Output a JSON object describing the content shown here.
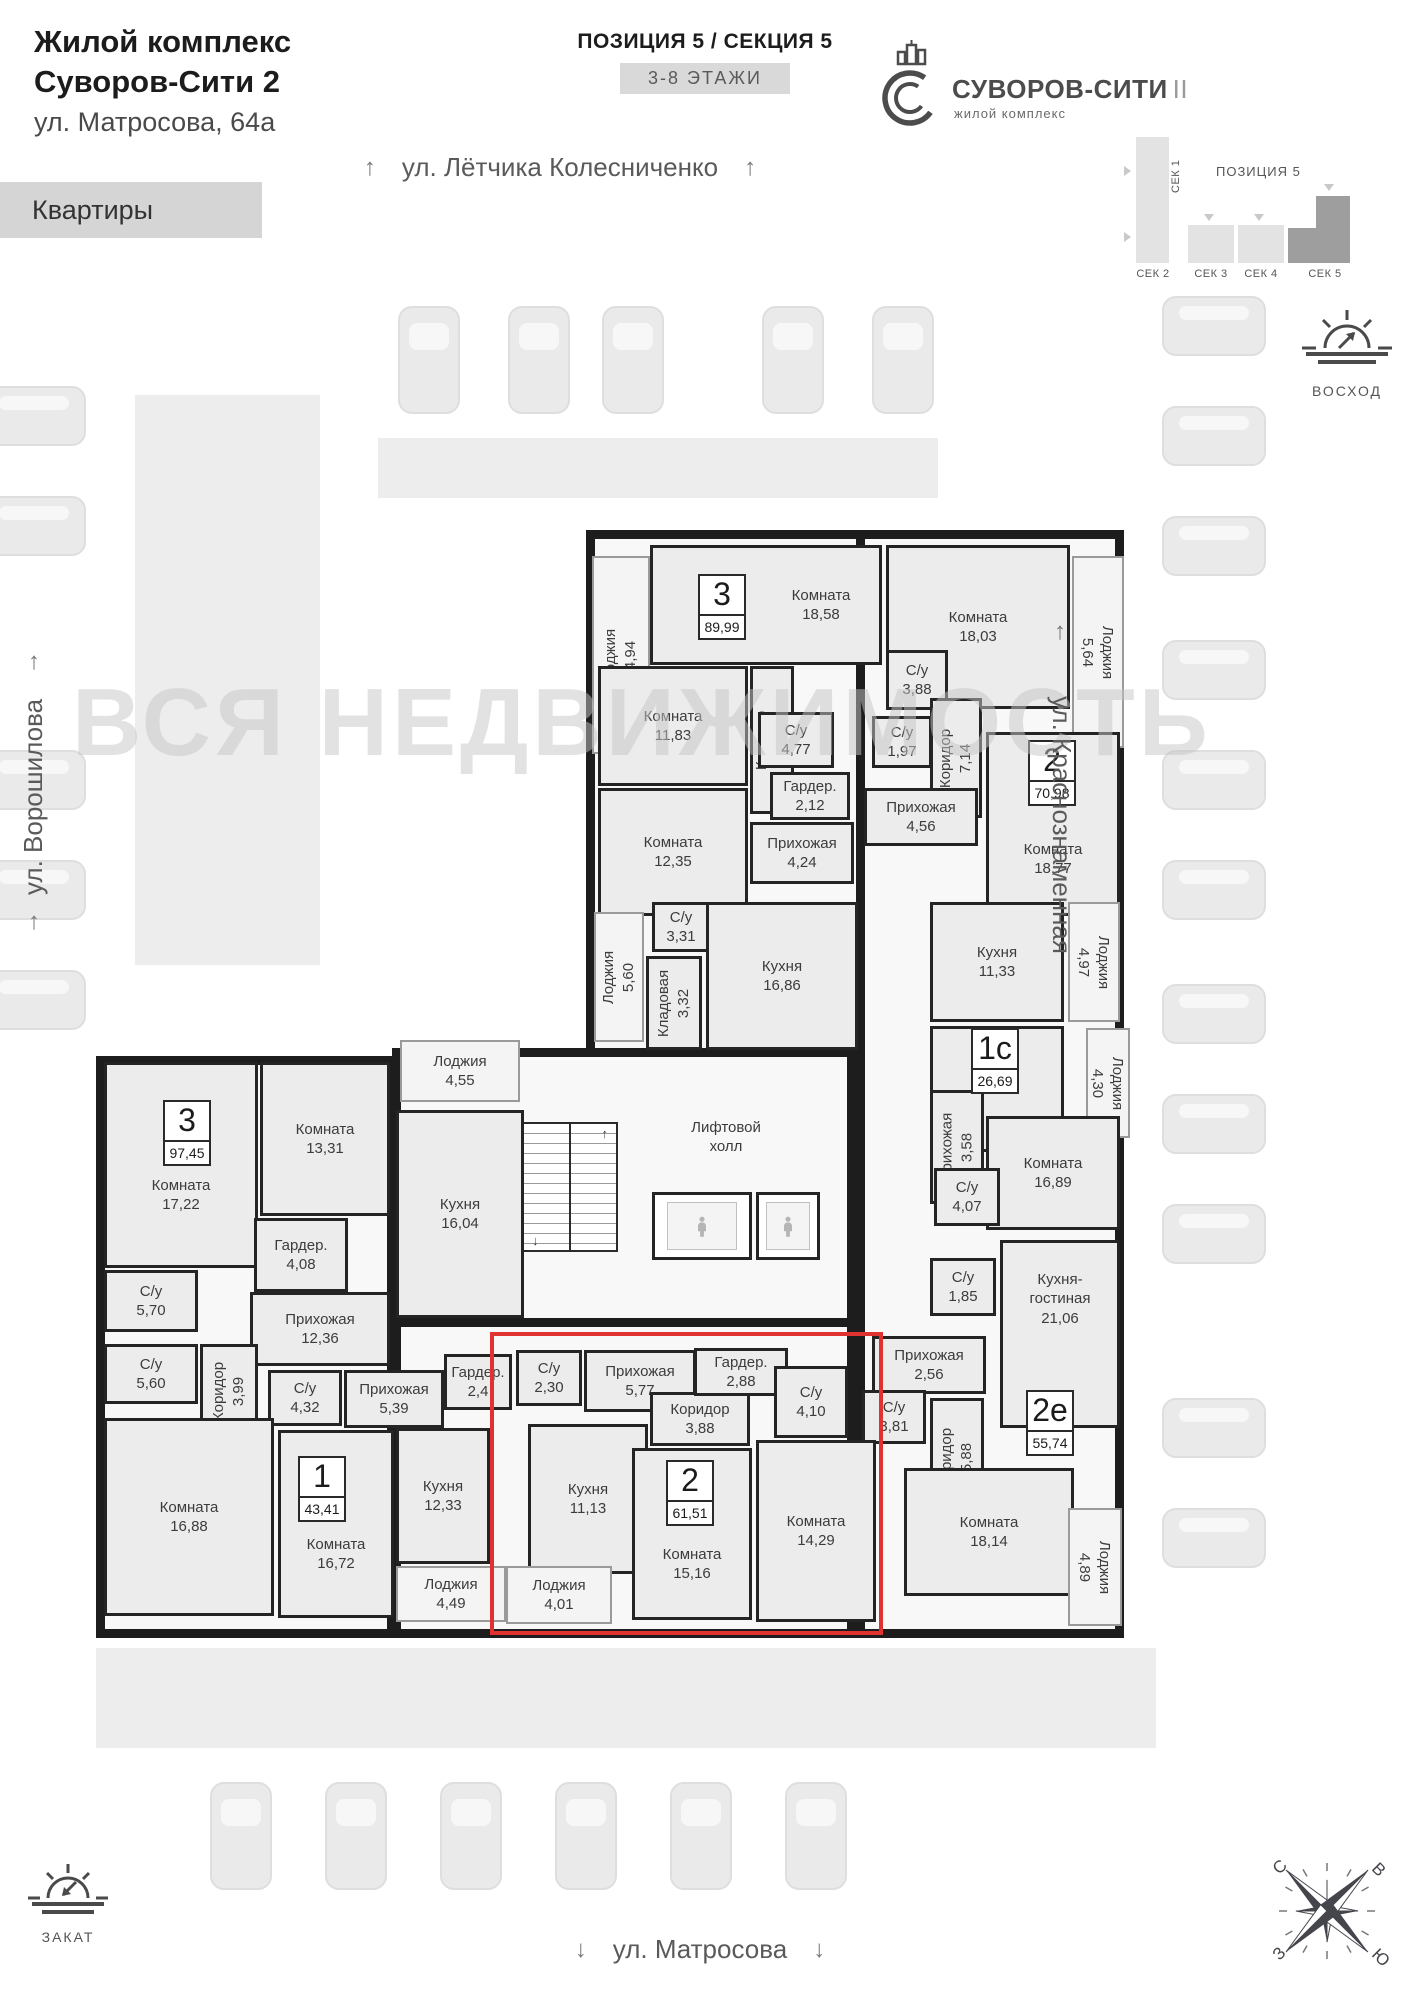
{
  "header": {
    "line1": "Жилой комплекс",
    "line2": "Суворов-Сити 2",
    "address": "ул. Матросова, 64а",
    "apartments_button": "Квартиры"
  },
  "position_header": {
    "title": "ПОЗИЦИЯ 5 / СЕКЦИЯ 5",
    "floors_badge": "3-8 ЭТАЖИ"
  },
  "logo": {
    "name": "СУВОРОВ-СИТИ",
    "suffix": "II",
    "subtitle": "жилой комплекс"
  },
  "minimap": {
    "position_label": "ПОЗИЦИЯ 5",
    "sections": [
      "СЕК 1",
      "СЕК 2",
      "СЕК 3",
      "СЕК 4",
      "СЕК 5"
    ]
  },
  "sun": {
    "sunrise": "ВОСХОД",
    "sunset": "ЗАКАТ"
  },
  "compass": {
    "north": "С",
    "east": "В",
    "west": "З",
    "south": "Ю"
  },
  "streets": {
    "top": "ул. Лётчика Колесниченко",
    "left": "ул. Ворошилова",
    "right": "ул. Краснознаменная",
    "bottom": "ул. Матросова",
    "arrow_up": "↑",
    "arrow_down": "↓"
  },
  "watermark": "ВСЯ НЕДВИЖИМОСТЬ",
  "plan": {
    "highlight": {
      "x": 490,
      "y": 1332,
      "w": 393,
      "h": 303,
      "color": "#e03331"
    },
    "wings": [
      [
        586,
        530,
        300,
        530
      ],
      [
        856,
        530,
        268,
        1108
      ],
      [
        96,
        1056,
        300,
        582
      ],
      [
        392,
        1048,
        464,
        282
      ],
      [
        392,
        1318,
        464,
        320
      ]
    ],
    "strips": [
      [
        378,
        438,
        560,
        60
      ],
      [
        135,
        395,
        185,
        570
      ],
      [
        96,
        1648,
        1060,
        100
      ]
    ],
    "cars": [
      [
        398,
        306,
        62,
        108
      ],
      [
        508,
        306,
        62,
        108
      ],
      [
        602,
        306,
        62,
        108
      ],
      [
        762,
        306,
        62,
        108
      ],
      [
        872,
        306,
        62,
        108
      ],
      [
        -18,
        386,
        104,
        60
      ],
      [
        -18,
        496,
        104,
        60
      ],
      [
        -18,
        750,
        104,
        60
      ],
      [
        -18,
        860,
        104,
        60
      ],
      [
        -18,
        970,
        104,
        60
      ],
      [
        1162,
        296,
        104,
        60
      ],
      [
        1162,
        406,
        104,
        60
      ],
      [
        1162,
        516,
        104,
        60
      ],
      [
        1162,
        640,
        104,
        60
      ],
      [
        1162,
        750,
        104,
        60
      ],
      [
        1162,
        860,
        104,
        60
      ],
      [
        1162,
        984,
        104,
        60
      ],
      [
        1162,
        1094,
        104,
        60
      ],
      [
        1162,
        1204,
        104,
        60
      ],
      [
        1162,
        1398,
        104,
        60
      ],
      [
        1162,
        1508,
        104,
        60
      ],
      [
        210,
        1782,
        62,
        108
      ],
      [
        325,
        1782,
        62,
        108
      ],
      [
        440,
        1782,
        62,
        108
      ],
      [
        555,
        1782,
        62,
        108
      ],
      [
        670,
        1782,
        62,
        108
      ],
      [
        785,
        1782,
        62,
        108
      ]
    ],
    "stairs": [
      522,
      1122,
      96,
      130
    ],
    "elevators": [
      [
        652,
        1192,
        100,
        68
      ],
      [
        756,
        1192,
        64,
        68
      ]
    ],
    "badges": [
      {
        "num": "3",
        "area": "89,99",
        "x": 698,
        "y": 574
      },
      {
        "num": "2",
        "area": "70,98",
        "x": 1028,
        "y": 740
      },
      {
        "num": "1с",
        "area": "26,69",
        "x": 971,
        "y": 1028
      },
      {
        "num": "2е",
        "area": "55,74",
        "x": 1026,
        "y": 1390
      },
      {
        "num": "3",
        "area": "97,45",
        "x": 163,
        "y": 1100
      },
      {
        "num": "1",
        "area": "43,41",
        "x": 298,
        "y": 1456
      },
      {
        "num": "2",
        "area": "61,51",
        "x": 666,
        "y": 1460
      }
    ],
    "rooms": [
      {
        "lines": [
          "Лоджия",
          "4,94"
        ],
        "r": [
          592,
          556,
          58,
          198
        ],
        "k": "loggia",
        "rot": 1
      },
      {
        "lines": [
          "Комната",
          "18,58"
        ],
        "r": [
          650,
          545,
          232,
          120
        ],
        "pl": 110
      },
      {
        "lines": [
          "Комната",
          "11,83"
        ],
        "r": [
          598,
          666,
          150,
          120
        ]
      },
      {
        "lines": [
          "Комната",
          "12,35"
        ],
        "r": [
          598,
          788,
          150,
          128
        ]
      },
      {
        "lines": [
          "Коридор",
          "7,34"
        ],
        "r": [
          750,
          666,
          44,
          148
        ],
        "rot": 1
      },
      {
        "lines": [
          "С/у",
          "4,77"
        ],
        "r": [
          758,
          712,
          76,
          56
        ]
      },
      {
        "lines": [
          "Гардер.",
          "2,12"
        ],
        "r": [
          770,
          772,
          80,
          48
        ]
      },
      {
        "lines": [
          "Прихожая",
          "4,24"
        ],
        "r": [
          750,
          822,
          104,
          62
        ]
      },
      {
        "lines": [
          "С/у",
          "3,31"
        ],
        "r": [
          652,
          902,
          58,
          50
        ]
      },
      {
        "lines": [
          "Кладовая",
          "3,32"
        ],
        "r": [
          646,
          956,
          56,
          94
        ],
        "rot": 1
      },
      {
        "lines": [
          "Кухня",
          "16,86"
        ],
        "r": [
          706,
          902,
          152,
          148
        ]
      },
      {
        "lines": [
          "Лоджия",
          "5,60"
        ],
        "r": [
          594,
          912,
          50,
          130
        ],
        "k": "loggia",
        "rot": 1
      },
      {
        "lines": [
          "Комната",
          "18,03"
        ],
        "r": [
          886,
          545,
          184,
          164
        ]
      },
      {
        "lines": [
          "Лоджия",
          "5,64"
        ],
        "r": [
          1072,
          556,
          52,
          192
        ],
        "k": "loggia",
        "rot": 2
      },
      {
        "lines": [
          "С/у",
          "3,88"
        ],
        "r": [
          886,
          650,
          62,
          60
        ]
      },
      {
        "lines": [
          "С/у",
          "1,97"
        ],
        "r": [
          872,
          716,
          60,
          52
        ]
      },
      {
        "lines": [
          "Коридор",
          "7,14"
        ],
        "r": [
          930,
          698,
          52,
          120
        ],
        "rot": 1
      },
      {
        "lines": [
          "Прихожая",
          "4,56"
        ],
        "r": [
          864,
          788,
          114,
          58
        ]
      },
      {
        "lines": [
          "Комната",
          "18,77"
        ],
        "r": [
          986,
          732,
          134,
          184
        ],
        "pt": 70
      },
      {
        "lines": [
          "Кухня",
          "11,33"
        ],
        "r": [
          930,
          902,
          134,
          120
        ]
      },
      {
        "lines": [
          "Лоджия",
          "4,97"
        ],
        "r": [
          1068,
          902,
          52,
          120
        ],
        "k": "loggia",
        "rot": 2
      },
      {
        "lines": [],
        "r": [
          930,
          1026,
          134,
          126
        ]
      },
      {
        "lines": [
          "Лоджия",
          "4,30"
        ],
        "r": [
          1086,
          1028,
          44,
          110
        ],
        "k": "loggia",
        "rot": 2
      },
      {
        "lines": [
          "Прихожая",
          "3,58"
        ],
        "r": [
          930,
          1090,
          54,
          114
        ],
        "rot": 1
      },
      {
        "lines": [
          "Комната",
          "16,89"
        ],
        "r": [
          986,
          1116,
          134,
          114
        ]
      },
      {
        "lines": [
          "С/у",
          "4,07"
        ],
        "r": [
          934,
          1168,
          66,
          58
        ]
      },
      {
        "lines": [
          "С/у",
          "1,85"
        ],
        "r": [
          930,
          1258,
          66,
          58
        ]
      },
      {
        "lines": [
          "Кухня-",
          "гостиная",
          "21,06"
        ],
        "r": [
          1000,
          1240,
          120,
          188
        ],
        "pb": 70
      },
      {
        "lines": [
          "Прихожая",
          "2,56"
        ],
        "r": [
          872,
          1336,
          114,
          58
        ]
      },
      {
        "lines": [
          "С/у",
          "3,81"
        ],
        "r": [
          862,
          1390,
          64,
          54
        ]
      },
      {
        "lines": [
          "Коридор",
          "5,88"
        ],
        "r": [
          930,
          1398,
          54,
          118
        ],
        "rot": 1
      },
      {
        "lines": [
          "Комната",
          "18,14"
        ],
        "r": [
          904,
          1468,
          170,
          128
        ]
      },
      {
        "lines": [
          "Лоджия",
          "4,89"
        ],
        "r": [
          1068,
          1508,
          54,
          118
        ],
        "k": "loggia",
        "rot": 2
      },
      {
        "lines": [
          "Лоджия",
          "4,55"
        ],
        "r": [
          400,
          1040,
          120,
          62
        ],
        "k": "loggia"
      },
      {
        "lines": [
          "Кухня",
          "16,04"
        ],
        "r": [
          396,
          1110,
          128,
          208
        ]
      },
      {
        "lines": [
          "Лифтовой",
          "холл"
        ],
        "r": [
          636,
          1072,
          180,
          130
        ],
        "k": "open"
      },
      {
        "lines": [
          "Комната",
          "17,22"
        ],
        "r": [
          104,
          1062,
          154,
          206
        ],
        "pt": 60
      },
      {
        "lines": [
          "Комната",
          "13,31"
        ],
        "r": [
          260,
          1062,
          130,
          154
        ]
      },
      {
        "lines": [
          "Гардер.",
          "4,08"
        ],
        "r": [
          254,
          1218,
          94,
          74
        ]
      },
      {
        "lines": [
          "С/у",
          "5,70"
        ],
        "r": [
          104,
          1270,
          94,
          62
        ]
      },
      {
        "lines": [
          "Прихожая",
          "12,36"
        ],
        "r": [
          250,
          1292,
          140,
          74
        ]
      },
      {
        "lines": [
          "С/у",
          "5,60"
        ],
        "r": [
          104,
          1344,
          94,
          60
        ]
      },
      {
        "lines": [
          "Коридор",
          "3,99"
        ],
        "r": [
          200,
          1344,
          58,
          94
        ],
        "rot": 1
      },
      {
        "lines": [
          "С/у",
          "4,32"
        ],
        "r": [
          268,
          1370,
          74,
          56
        ]
      },
      {
        "lines": [
          "Комната",
          "16,88"
        ],
        "r": [
          104,
          1418,
          170,
          198
        ]
      },
      {
        "lines": [
          "Прихожая",
          "5,39"
        ],
        "r": [
          344,
          1370,
          100,
          58
        ]
      },
      {
        "lines": [
          "Комната",
          "16,72"
        ],
        "r": [
          278,
          1430,
          116,
          188
        ],
        "pt": 60
      },
      {
        "lines": [
          "Кухня",
          "12,33"
        ],
        "r": [
          396,
          1428,
          94,
          136
        ]
      },
      {
        "lines": [
          "Лоджия",
          "4,49"
        ],
        "r": [
          396,
          1566,
          110,
          56
        ],
        "k": "loggia"
      },
      {
        "lines": [
          "Гардер.",
          "2,4"
        ],
        "r": [
          444,
          1354,
          68,
          56
        ]
      },
      {
        "lines": [
          "С/у",
          "2,30"
        ],
        "r": [
          516,
          1350,
          66,
          56
        ]
      },
      {
        "lines": [
          "Прихожая",
          "5,77"
        ],
        "r": [
          584,
          1350,
          112,
          62
        ]
      },
      {
        "lines": [
          "Кухня",
          "11,13"
        ],
        "r": [
          528,
          1424,
          120,
          150
        ]
      },
      {
        "lines": [
          "Коридор",
          "3,88"
        ],
        "r": [
          650,
          1392,
          100,
          54
        ]
      },
      {
        "lines": [
          "Комната",
          "15,16"
        ],
        "r": [
          632,
          1448,
          120,
          172
        ],
        "pt": 60
      },
      {
        "lines": [
          "Гардер.",
          "2,88"
        ],
        "r": [
          694,
          1348,
          94,
          48
        ]
      },
      {
        "lines": [
          "С/у",
          "4,10"
        ],
        "r": [
          774,
          1366,
          74,
          72
        ]
      },
      {
        "lines": [
          "Комната",
          "14,29"
        ],
        "r": [
          756,
          1440,
          120,
          182
        ]
      },
      {
        "lines": [
          "Лоджия",
          "4,01"
        ],
        "r": [
          506,
          1566,
          106,
          58
        ],
        "k": "loggia"
      }
    ]
  }
}
